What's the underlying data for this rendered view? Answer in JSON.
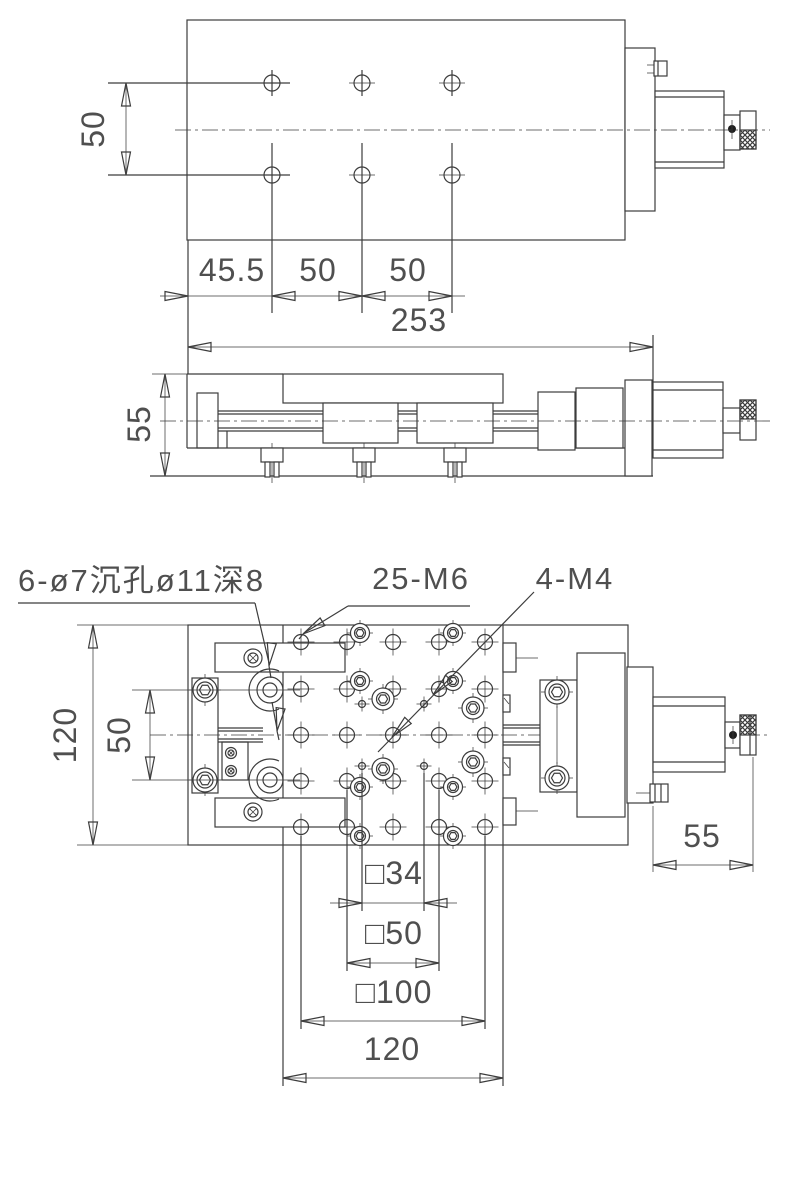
{
  "colors": {
    "line": "#3c3c3c",
    "text": "#4f4f4f",
    "arrow_fill": "#1f1f1f",
    "background": "#ffffff"
  },
  "top_view": {
    "dim_hole_row_spacing": "50",
    "dim_left_offset": "45.5",
    "dim_col_spacing_1": "50",
    "dim_col_spacing_2": "50",
    "dim_overall_length": "253"
  },
  "side_view": {
    "dim_height": "55"
  },
  "bottom_view": {
    "label_counterbore_holes": "6-ø7沉孔ø11深8",
    "label_grid_holes": "25-M6",
    "label_corner_holes": "4-M4",
    "dim_stage_height": "120",
    "dim_hole_row_spacing": "50",
    "dim_square_34": "□34",
    "dim_square_50": "□50",
    "dim_square_100": "□100",
    "dim_table_width": "120",
    "dim_micrometer_length": "55"
  }
}
